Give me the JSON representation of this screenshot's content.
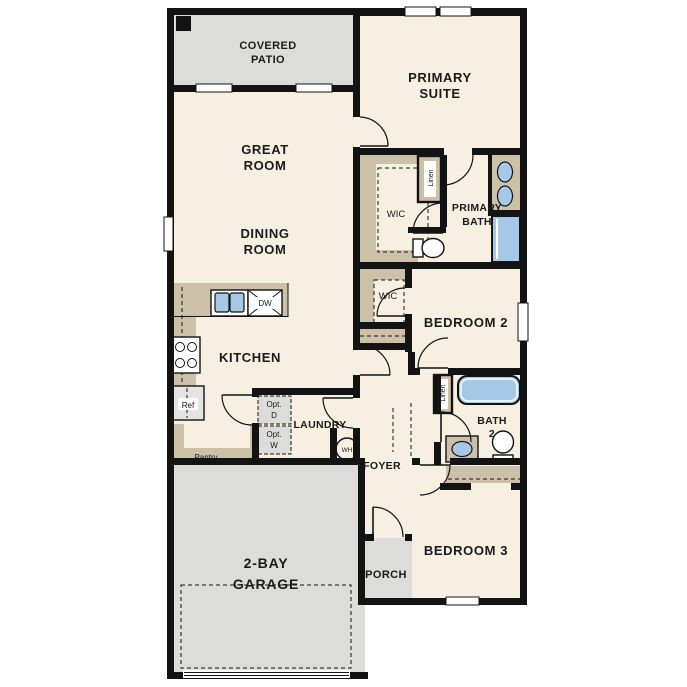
{
  "plan": {
    "type": "single-story-residential-floor-plan",
    "bedrooms": 3,
    "garage_bays": 2
  },
  "colors": {
    "room_fill": "#f7f0e2",
    "patio_garage_fill": "#dcdcda",
    "cabinet_closet_fill": "#cdc0a8",
    "plumbing_fixture_fill": "#a5c8e7",
    "wall": "#131313",
    "background": "#ffffff"
  },
  "labels": {
    "covered_patio_1": "COVERED",
    "covered_patio_2": "PATIO",
    "primary_suite_1": "PRIMARY",
    "primary_suite_2": "SUITE",
    "great_room_1": "GREAT",
    "great_room_2": "ROOM",
    "dining_room_1": "DINING",
    "dining_room_2": "ROOM",
    "wic_primary": "WIC",
    "wic_bedroom2": "WIC",
    "linen_primary": "Linen",
    "linen_bath2": "Linen",
    "primary_bath_1": "PRIMARY",
    "primary_bath_2": "BATH",
    "bedroom2": "BEDROOM 2",
    "bedroom3": "BEDROOM 3",
    "kitchen": "KITCHEN",
    "laundry": "LAUNDRY",
    "foyer": "FOYER",
    "bath2_1": "BATH",
    "bath2_2": "2",
    "porch": "PORCH",
    "garage_1": "2-BAY",
    "garage_2": "GARAGE",
    "pantry": "Pantry",
    "refrigerator": "Ref",
    "dishwasher": "DW",
    "water_heater": "WH",
    "opt_dryer_1": "Opt.",
    "opt_dryer_2": "D",
    "opt_washer_1": "Opt.",
    "opt_washer_2": "W"
  }
}
